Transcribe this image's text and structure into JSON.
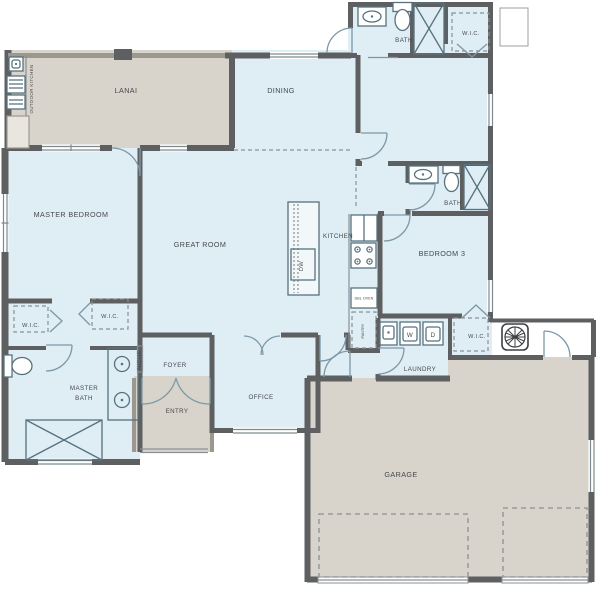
{
  "plan": {
    "rooms": {
      "lanai": "LANAI",
      "outdoor_kitchen": "OUTDOOR KITCHEN",
      "dining": "DINING",
      "great_room": "GREAT ROOM",
      "kitchen": "KITCHEN",
      "master_bedroom": "MASTER BEDROOM",
      "master_bath_line1": "MASTER",
      "master_bath_line2": "BATH",
      "wic_master_left": "W.I.C.",
      "wic_master_right": "W.I.C.",
      "foyer": "FOYER",
      "niche": "NICHE",
      "entry": "ENTRY",
      "office": "OFFICE",
      "laundry": "LAUNDRY",
      "garage": "GARAGE",
      "bedroom3": "BEDROOM 3",
      "bath_upper": "BATH",
      "wic_upper": "W.I.C.",
      "bath_right": "BATH",
      "wic_bedroom3": "W.I.C."
    },
    "appliances": {
      "washer": "W",
      "dryer": "D",
      "dishwasher": "DW",
      "double_oven": "DBL OVEN",
      "pantry": "PANTRY"
    },
    "colors": {
      "interior_floor": "#dfedf5",
      "outdoor_floor": "#d8d4cb",
      "wall": "#5e5f60",
      "screen_wall": "#9b988f",
      "fixture_line": "#57727f",
      "door_line": "#7d98a6",
      "label_text": "#45494d"
    }
  }
}
